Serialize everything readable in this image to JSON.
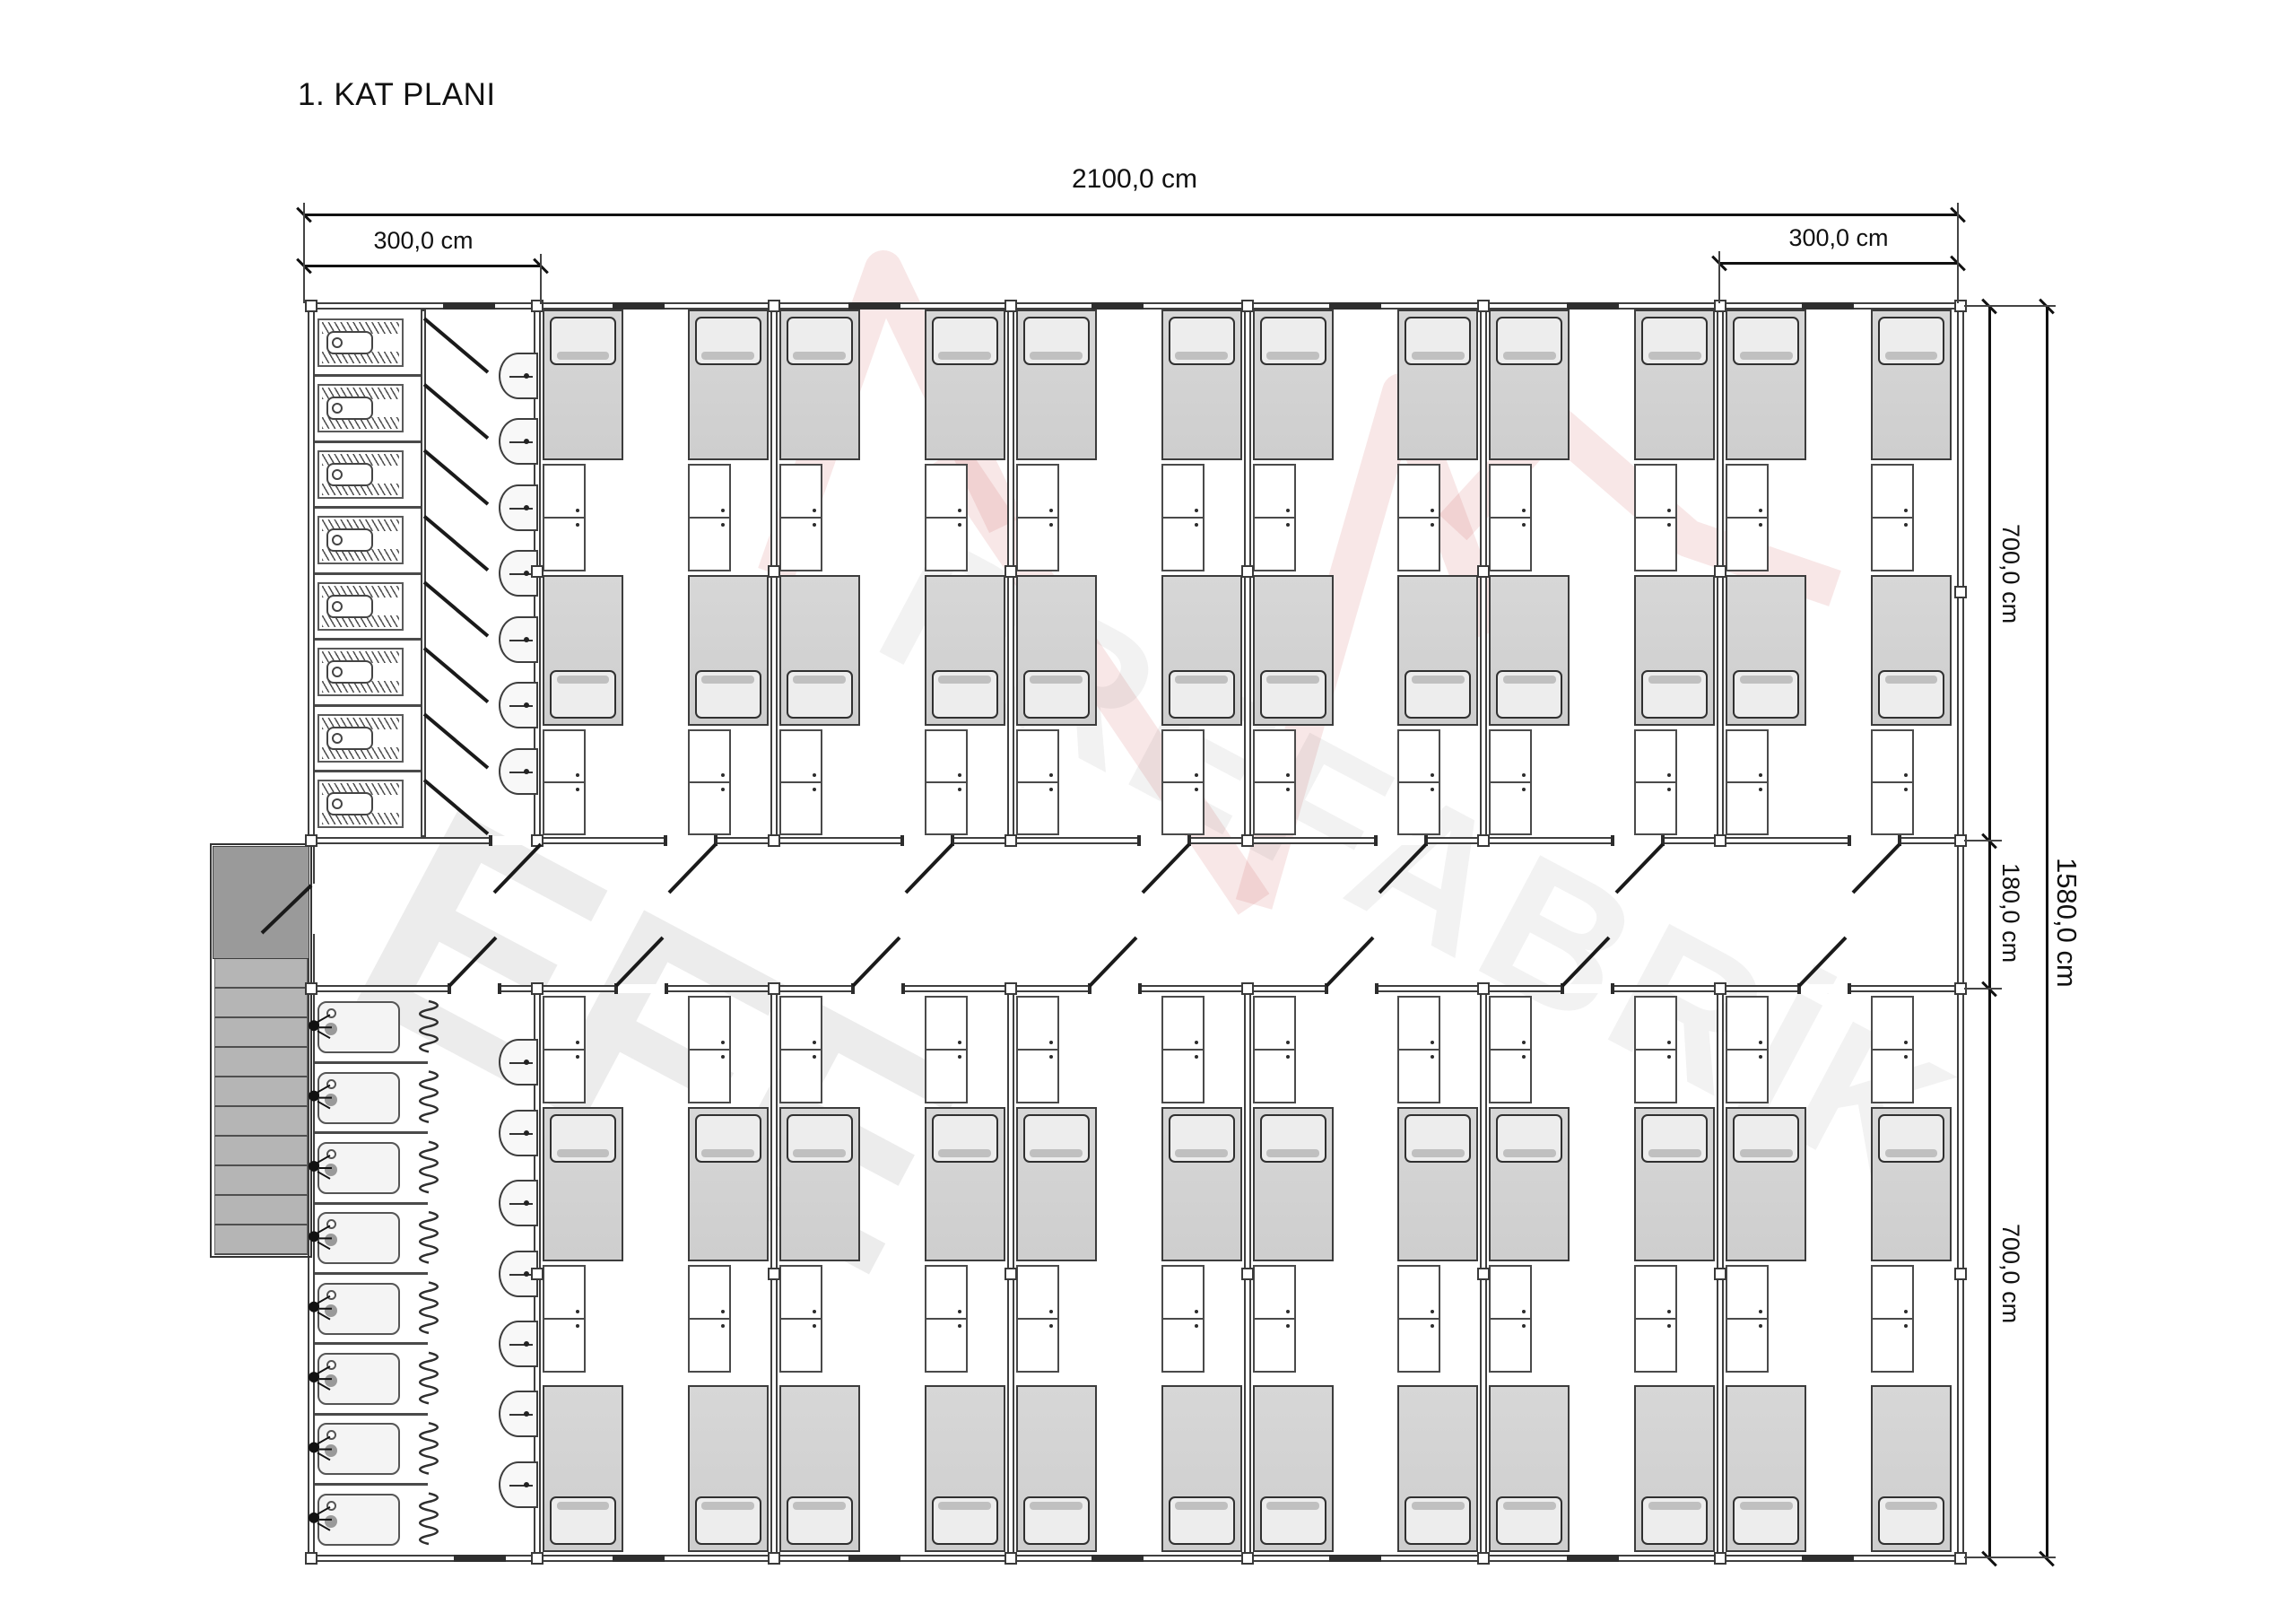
{
  "title": "1. KAT PLANI",
  "dimensions": {
    "total_width": "2100,0 cm",
    "left_module_width": "300,0 cm",
    "right_module_width": "300,0 cm",
    "top_wing_depth": "700,0 cm",
    "corridor_depth": "180,0 cm",
    "bottom_wing_depth": "700,0 cm",
    "total_depth": "1580,0 cm"
  },
  "watermark": {
    "brand": "EFE",
    "brand_suffix": "PREFABRİK",
    "logo_icon": "mountain-logo"
  },
  "plan": {
    "bedrooms_per_wing": 6,
    "beds_per_room": 4,
    "total_beds": 48,
    "wc_stalls": 8,
    "wc_sinks": 7,
    "shower_stalls": 8,
    "shower_sinks": 7,
    "colors": {
      "line": "#3f3f3f",
      "bed_fill": "#d3d3d3",
      "pillow_fill": "#ededed",
      "cabinet_fill": "#ffffff",
      "stair_landing": "#9a9a9a",
      "stair_tread": "#b5b5b5",
      "window_bar": "#2e2e2e",
      "dimension": "#111111",
      "watermark_text": "rgba(0,0,0,0.075)",
      "watermark_text_light": "rgba(0,0,0,0.05)",
      "watermark_logo": "rgba(196,60,60,0.12)",
      "door_line": "#1a1a1a"
    }
  }
}
